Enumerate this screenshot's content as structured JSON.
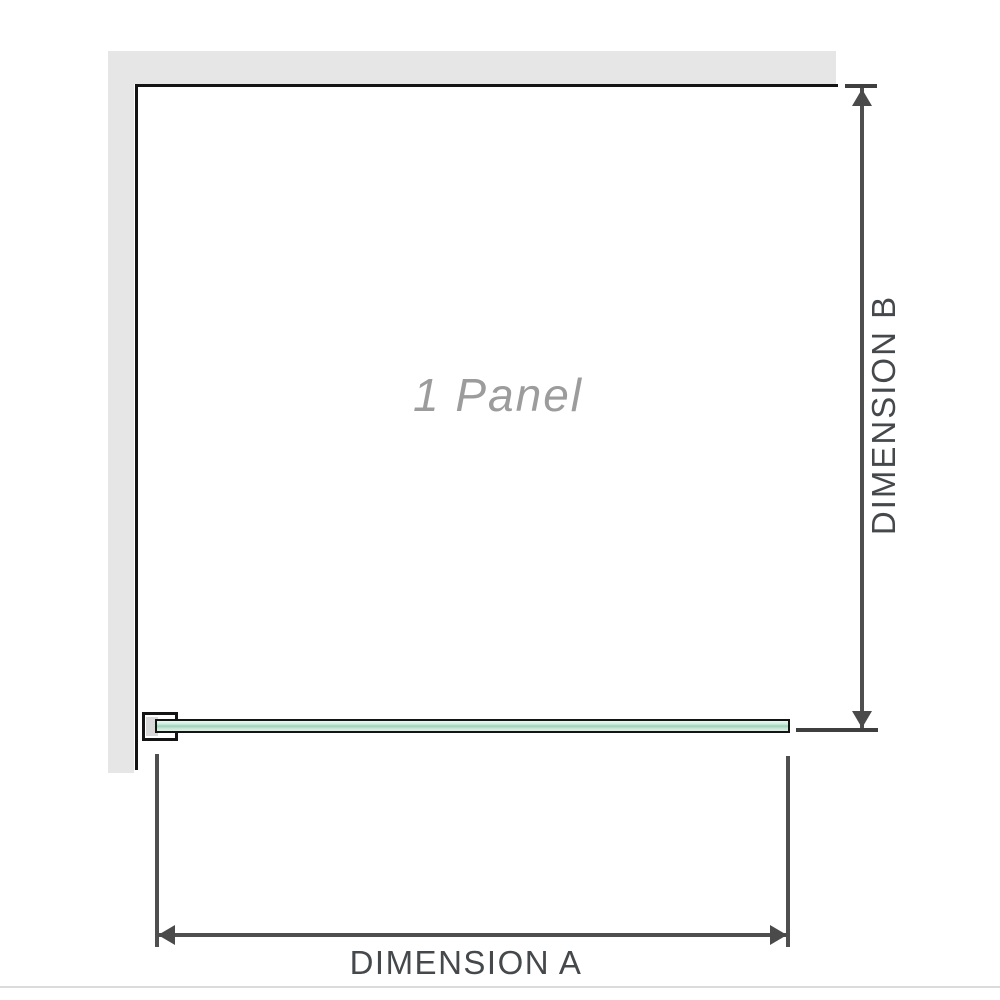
{
  "diagram": {
    "panel_label": "1 Panel",
    "dimensions": {
      "a_label": "DIMENSION A",
      "b_label": "DIMENSION B"
    },
    "colors": {
      "wall": "#e6e6e6",
      "outline": "#141414",
      "glass_light": "#d2ecdf",
      "glass_dark": "#9fd3ba",
      "arrow": "#4a4a4a",
      "dimension_text": "#45494c",
      "panel_text": "#9c9c9c",
      "bracket_fill": "#d8d8d8",
      "separator": "#dbdbdb"
    }
  }
}
